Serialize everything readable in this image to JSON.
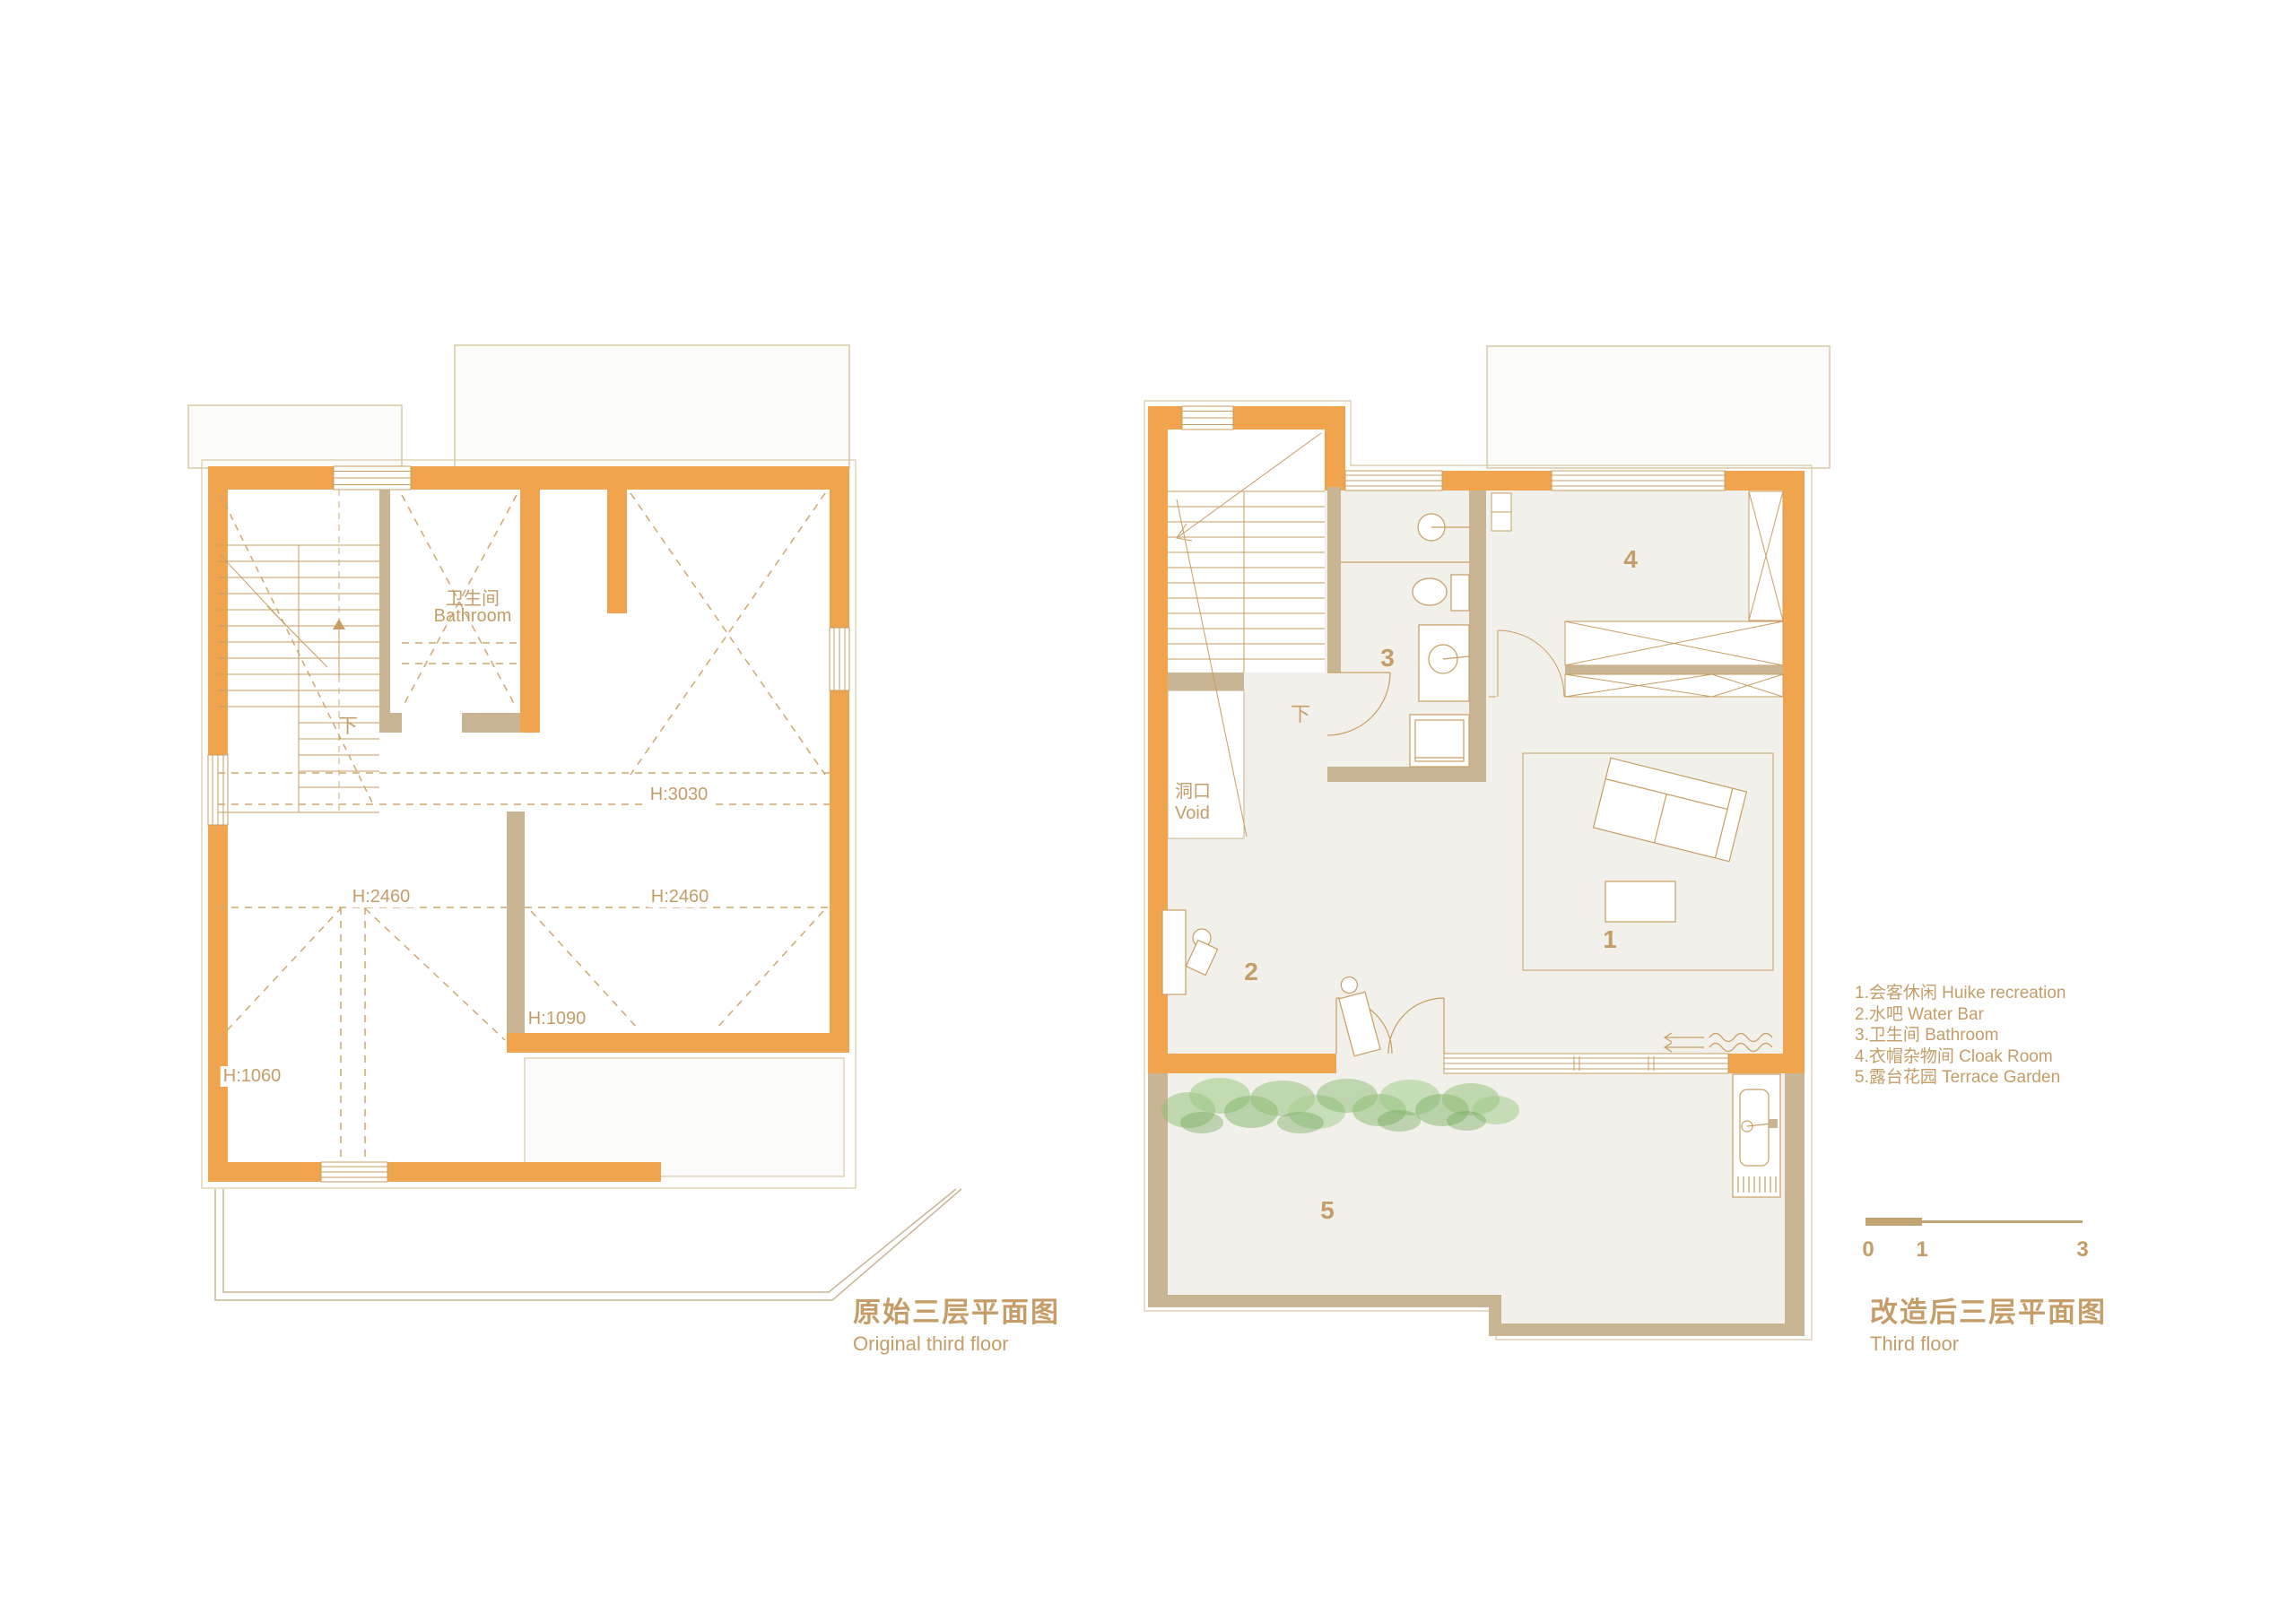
{
  "left_plan": {
    "title_cn": "原始三层平面图",
    "title_en": "Original third floor",
    "labels": {
      "bathroom_cn": "卫生间",
      "bathroom_en": "Bathroom",
      "down": "下",
      "h_3030": "H:3030",
      "h_2460_left": "H:2460",
      "h_2460_right": "H:2460",
      "h_1090": "H:1090",
      "h_1060": "H:1060"
    }
  },
  "right_plan": {
    "title_cn": "改造后三层平面图",
    "title_en": "Third floor",
    "labels": {
      "void_cn": "洞口",
      "void_en": "Void",
      "down": "下",
      "room_1": "1",
      "room_2": "2",
      "room_3": "3",
      "room_4": "4",
      "room_5": "5"
    }
  },
  "legend": {
    "items": [
      "1.会客休闲 Huike recreation",
      "2.水吧 Water Bar",
      "3.卫生间 Bathroom",
      "4.衣帽杂物间 Cloak Room",
      "5.露台花园 Terrace Garden"
    ]
  },
  "scale_bar": {
    "tick_0": "0",
    "tick_1": "1",
    "tick_3": "3"
  },
  "colors": {
    "wall_orange": "#F0A44D",
    "wall_tan": "#C9B593",
    "line_gold": "#C79E63",
    "dashed_line": "#CFA76F",
    "text_gold": "#C49D68",
    "floor_beige": "#F2F0EA",
    "roof_fill": "#FBFBF9",
    "roof_line": "#D8C8A6",
    "plant_green": "#8FBE74"
  }
}
